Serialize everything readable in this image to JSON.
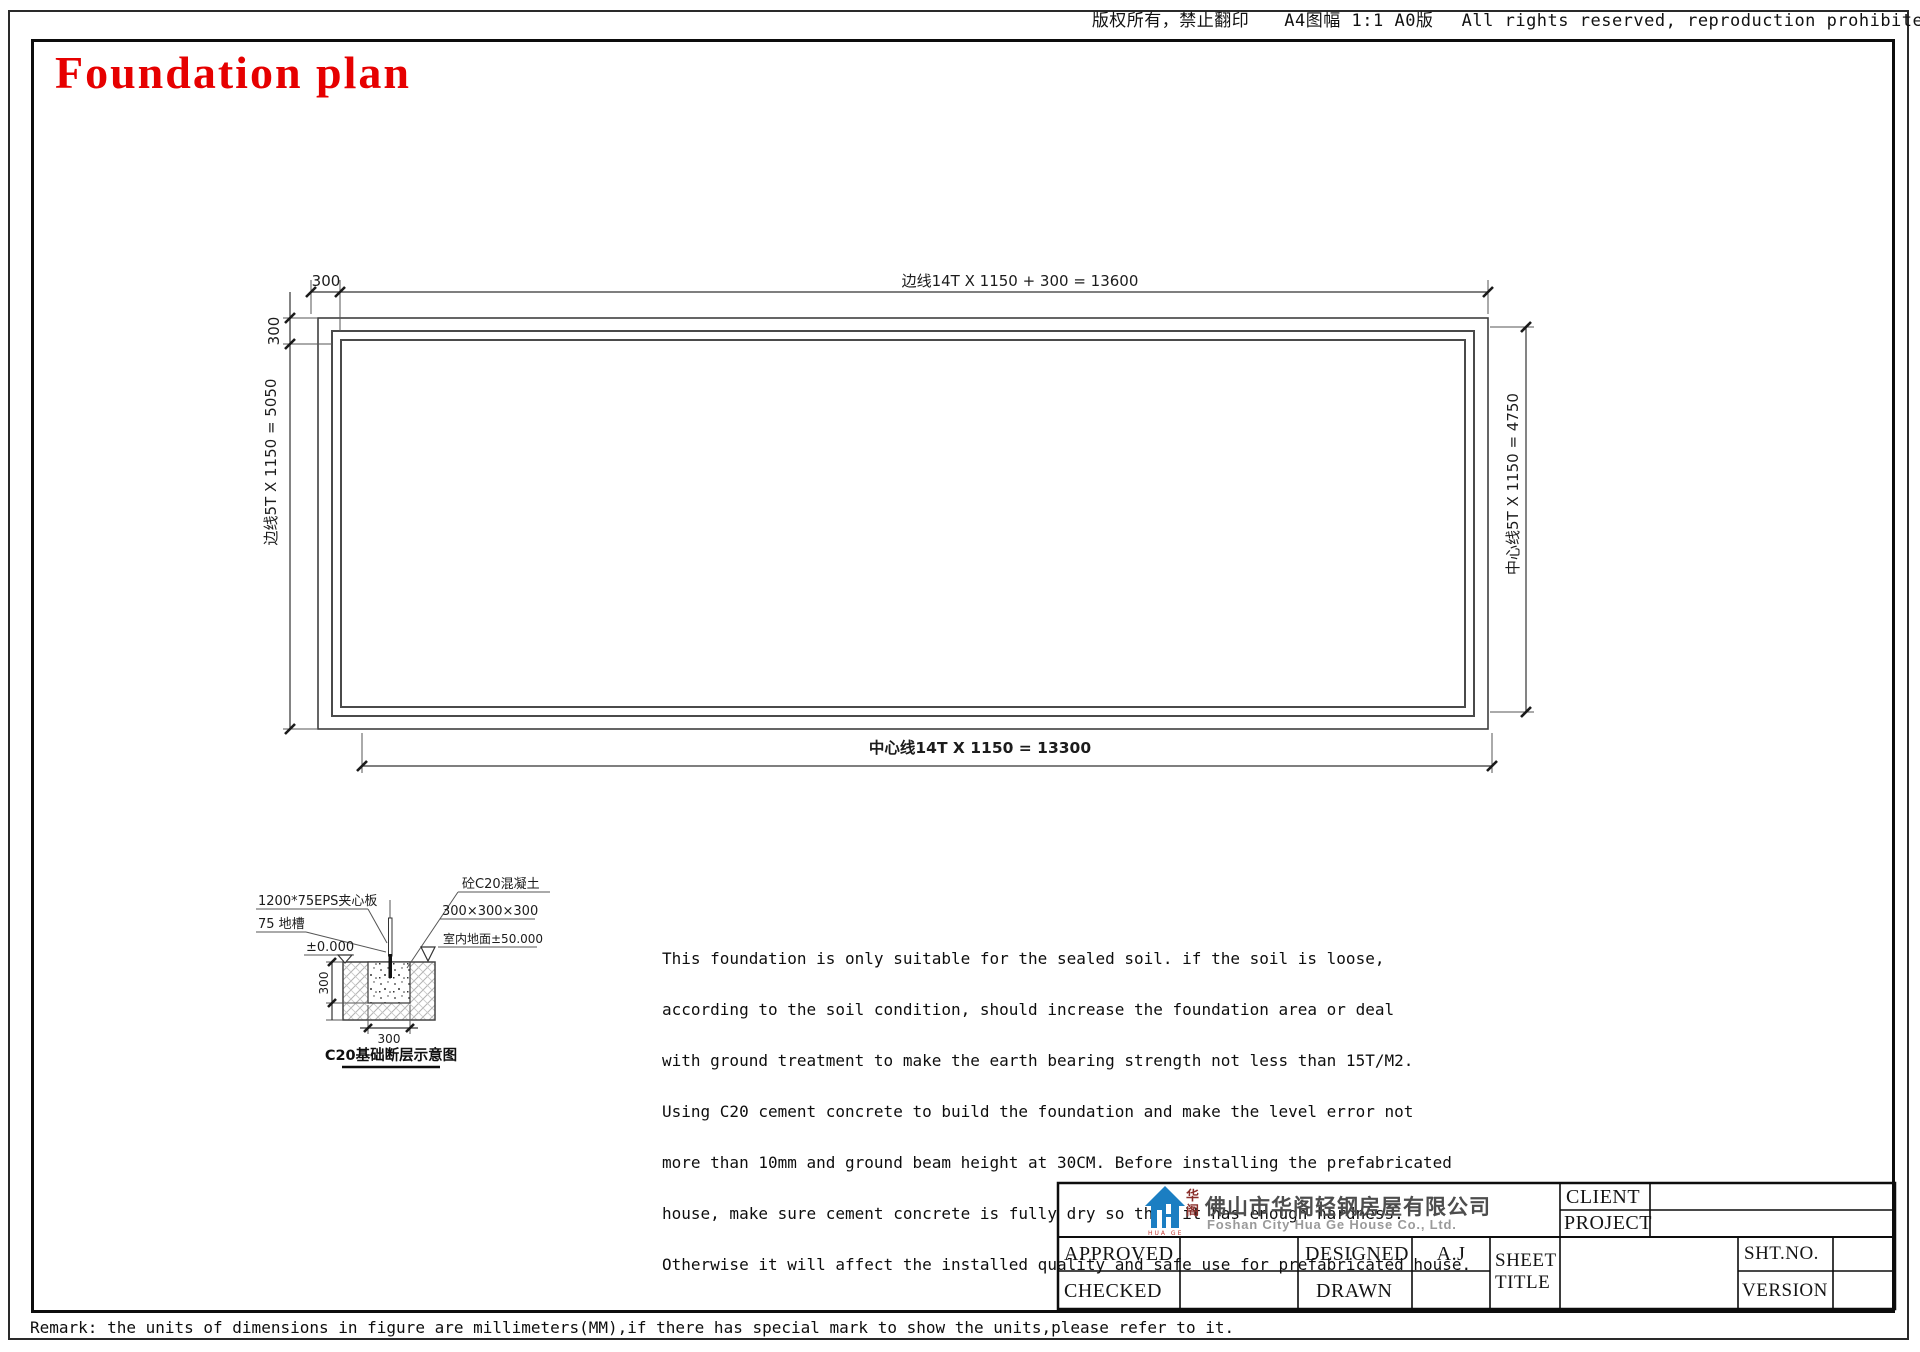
{
  "header": {
    "copyright": "版权所有，禁止翻印　　A4图幅 1:1 A0版　 All rights reserved, reproduction prohibited"
  },
  "title": "Foundation plan",
  "plan": {
    "dim_top_small": "300",
    "dim_top_main": "边线14T X 1150 + 300  = 13600",
    "dim_left_small": "300",
    "dim_left_main": "边线5T X 1150 = 5050",
    "dim_right_main": "中心线5T X 1150 = 4750",
    "dim_bottom_main": "中心线14T X 1150   = 13300"
  },
  "detail": {
    "label_eps": "1200*75EPS夹心板",
    "label_trench": "75 地槽",
    "label_level_zero": "±0.000",
    "label_concrete": "砼C20混凝土",
    "label_concrete_size": "300×300×300",
    "label_floor_level": "室内地面±50.000",
    "dim_depth": "300",
    "dim_width": "300",
    "caption": "C20基础断层示意图"
  },
  "notes": {
    "lines": [
      "This foundation is only suitable for the sealed soil. if the soil is loose,",
      "according to the soil condition, should increase the foundation area or deal",
      "with ground treatment to make the earth bearing strength not less than 15T/M2.",
      "Using C20 cement concrete to build the foundation and make the level error not",
      "more than 10mm and ground beam height at 30CM. Before installing the prefabricated",
      "house, make sure cement concrete is fully dry so that it has enough hardness.",
      "Otherwise it will affect the installed quality and safe use for prefabricated house."
    ]
  },
  "titleblock": {
    "company_cn": "佛山市华阁轻钢房屋有限公司",
    "company_en": "Foshan City Hua Ge House Co., Ltd.",
    "logo_char_top": "华",
    "logo_char_bottom": "阁",
    "logo_sub": "HUA GE",
    "client_label": "CLIENT",
    "project_label": "PROJECT",
    "approved_label": "APPROVED",
    "checked_label": "CHECKED",
    "designed_label": "DESIGNED",
    "drawn_label": "DRAWN",
    "designed_value": "A.J",
    "sheet_title_line1": "SHEET",
    "sheet_title_line2": "TITLE",
    "shtno_label": "SHT.NO.",
    "version_label": "VERSION"
  },
  "remark": "Remark: the units of dimensions in figure are millimeters(MM),if there has special mark to show the units,please refer to it.",
  "colors": {
    "accent_red": "#e60000",
    "logo_blue": "#1b7ec2",
    "line": "#3a3a3a"
  }
}
